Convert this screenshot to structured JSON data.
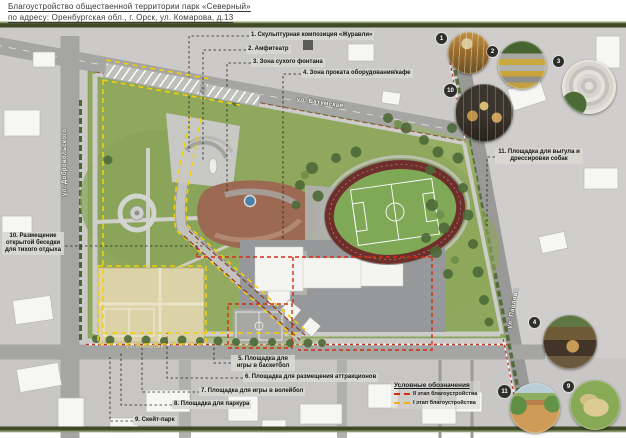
{
  "title": {
    "line1": "Благоустройство общественной территории парк «Северный»",
    "line2": "по адресу: Оренбургская обл., г. Орск, ул. Комарова, д.13"
  },
  "streets": {
    "top": "ул. Батумская",
    "left": "ул. Добровольского",
    "right": "ул. Павлова",
    "bottom": "ул. Комарова"
  },
  "callouts": [
    {
      "text": "1. Скульптурная композиция «Журавли»"
    },
    {
      "text": "2. Амфитеатр"
    },
    {
      "text": "3. Зона сухого фонтана"
    },
    {
      "text": "4. Зона проката оборудования/кафе"
    },
    {
      "text": "5. Площадка для игры в баскетбол"
    },
    {
      "text": "6. Площадка для размещения аттракционов"
    },
    {
      "text": "7. Площадка для игры в волейбол"
    },
    {
      "text": "8. Площадка для паркура"
    },
    {
      "text": "9. Скейт-парк"
    },
    {
      "text": "10. Размещение открытой беседки для тихого отдыха"
    },
    {
      "text": "11. Площадка для выгула и дрессировки собак"
    }
  ],
  "photos": [
    {
      "num": "1"
    },
    {
      "num": "2"
    },
    {
      "num": "3"
    },
    {
      "num": "10"
    },
    {
      "num": "4"
    },
    {
      "num": "11"
    },
    {
      "num": "9"
    }
  ],
  "legend": {
    "header": "Условные обозначения",
    "items": [
      {
        "label": "II этап благоустройства",
        "color": "#d42c16"
      },
      {
        "label": "I этап благоустройства",
        "color": "#efb01a"
      }
    ]
  },
  "colors": {
    "stage1_yellow": "#f2cf0a",
    "stage2_red": "#d42c16",
    "park_green": "#8fa85d",
    "track_red": "#6e2f2b",
    "band_olive": "#3e4b26",
    "map_gray": "#cbcac8",
    "plaza_brown": "#9c6a53",
    "fountain_blue": "#4a80a8"
  }
}
